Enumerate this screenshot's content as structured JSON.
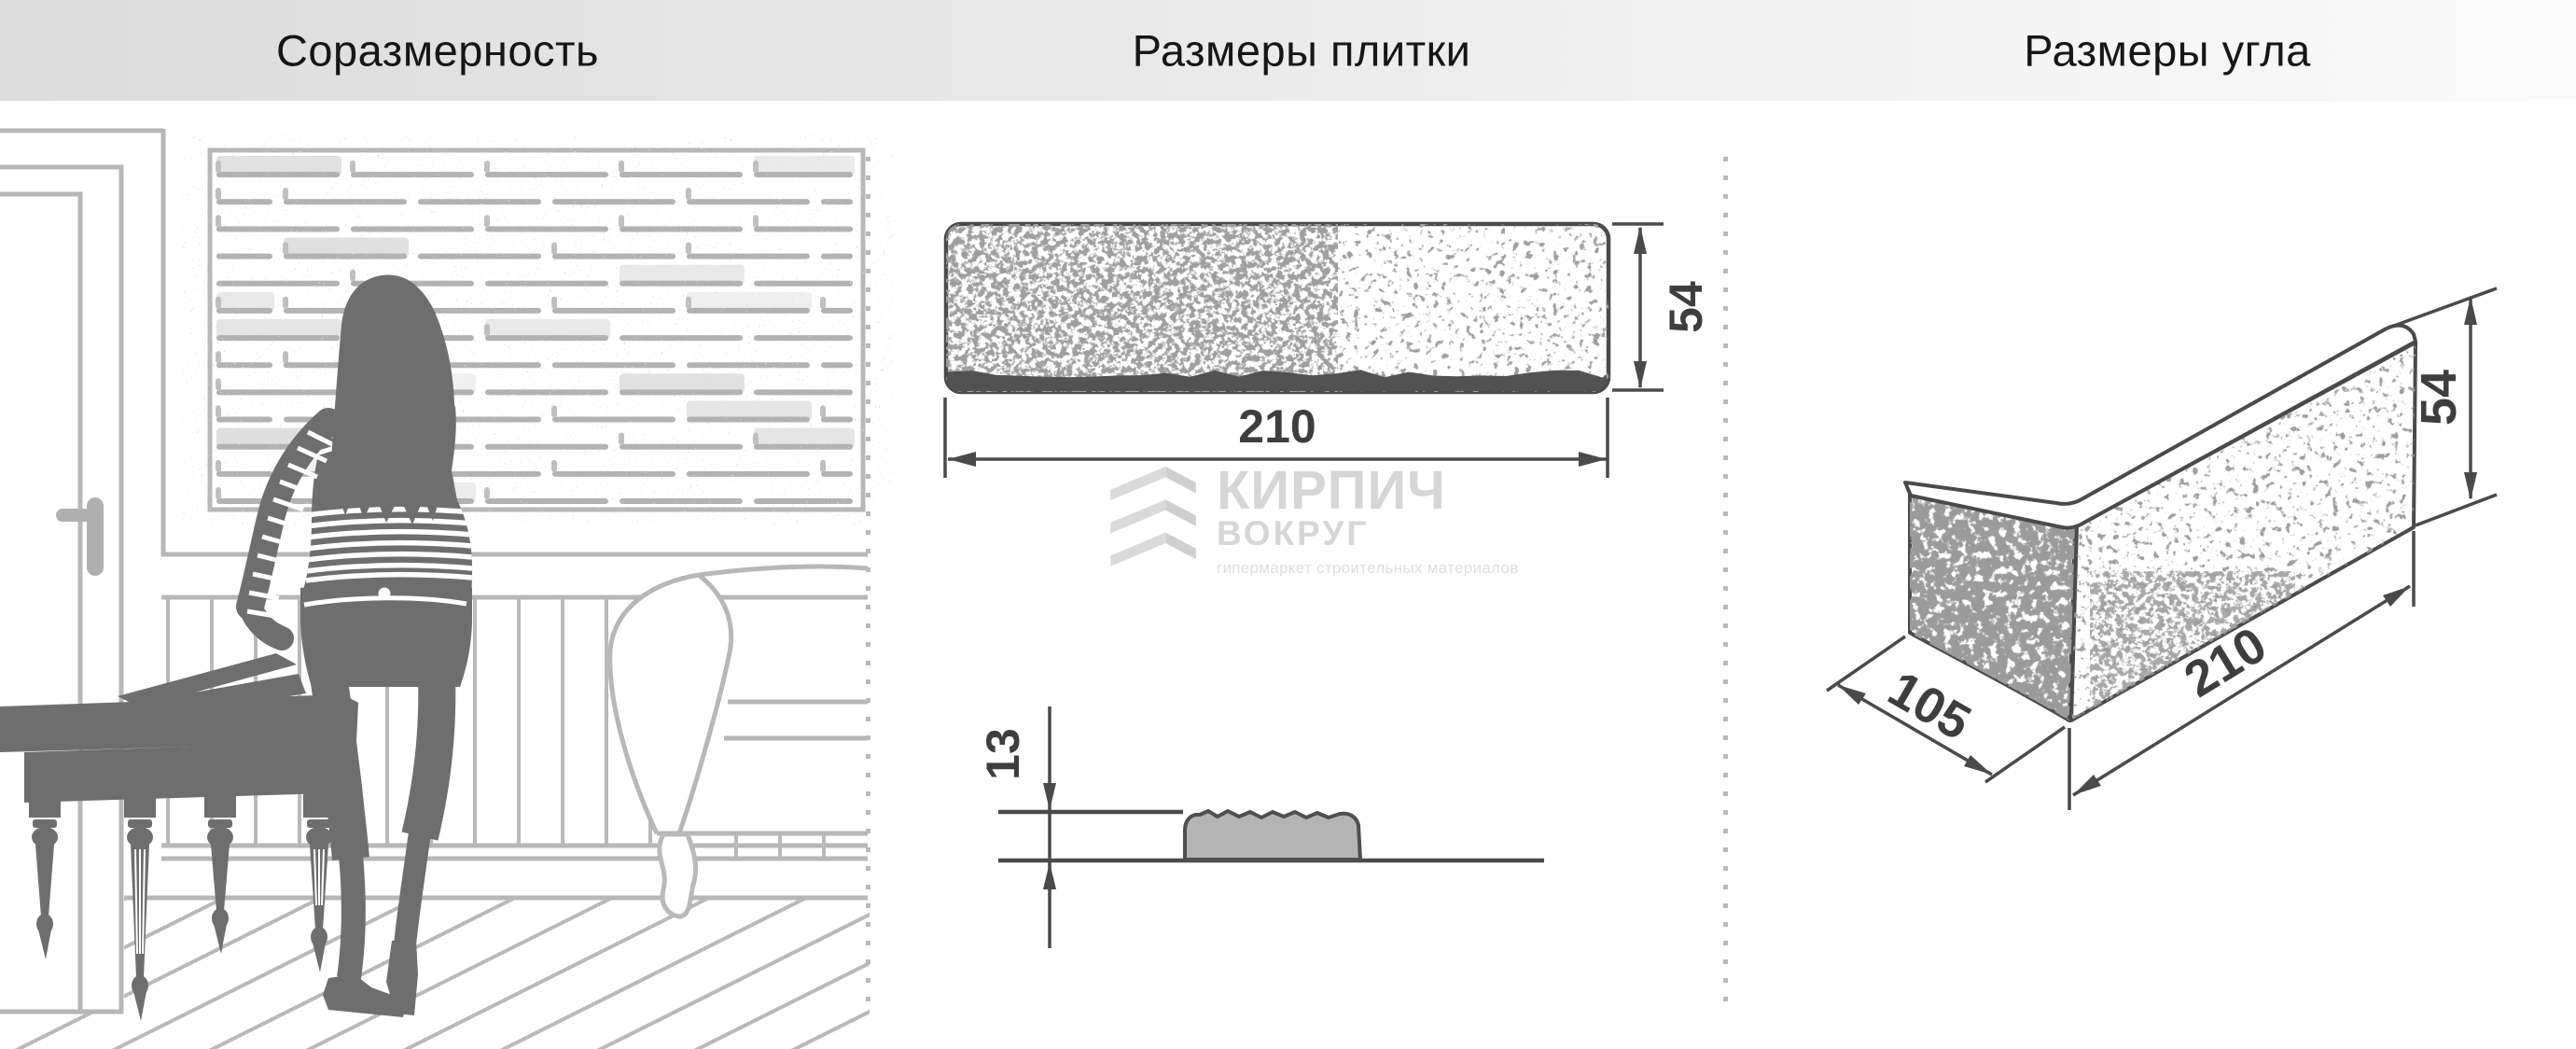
{
  "header": {
    "titles": [
      {
        "id": "proportionality",
        "label": "Соразмерность"
      },
      {
        "id": "tile-dimensions",
        "label": "Размеры плитки"
      },
      {
        "id": "corner-dimensions",
        "label": "Размеры угла"
      }
    ]
  },
  "watermark": {
    "brand_line1": "КИРПИЧ",
    "brand_line2": "ВОКРУГ",
    "tagline": "гипермаркет строительных материалов"
  },
  "tile_drawing": {
    "length_label": "210",
    "height_label": "54",
    "thickness_label": "13"
  },
  "corner_drawing": {
    "depth_label": "105",
    "length_label": "210",
    "height_label": "54"
  },
  "colors": {
    "dimension_line": "#4a4a4a",
    "scene_line": "#b7b7b7",
    "silhouette": "#6e6e6e",
    "watermark": "#d9d9d9",
    "header_gradient_start": "#dcdcdc",
    "header_gradient_end": "#fafafa"
  }
}
